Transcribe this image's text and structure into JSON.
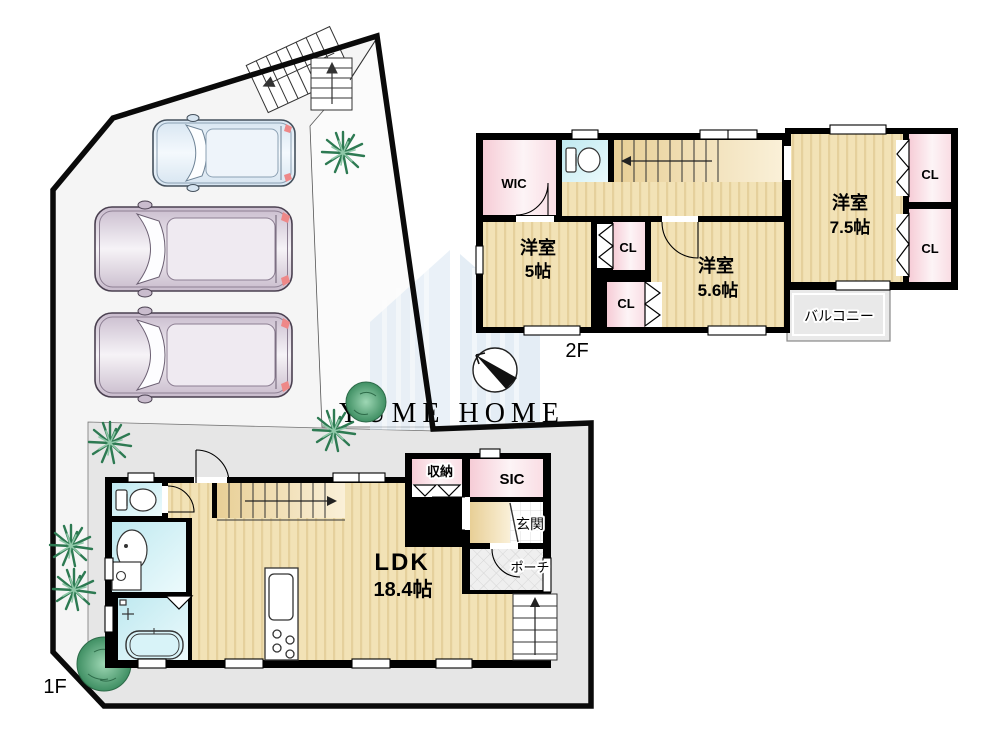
{
  "floor1": {
    "label": "1F",
    "ldk_name": "LDK",
    "ldk_size": "18.4帖",
    "storage": "収納",
    "sic": "SIC",
    "entrance": "玄関",
    "porch": "ポーチ"
  },
  "floor2": {
    "label": "2F",
    "wic": "WIC",
    "cl": "CL",
    "room5_name": "洋室",
    "room5_size": "5帖",
    "room56_name": "洋室",
    "room56_size": "5.6帖",
    "room75_name": "洋室",
    "room75_size": "7.5帖",
    "balcony": "バルコニー"
  },
  "watermark": {
    "text": "YUME HOME"
  },
  "colors": {
    "floor_tan": "#f2e2b6",
    "floor_stripe": "#e5d09c",
    "stair_tan": "#f5e8c6",
    "closet_pink": "#f6ccd6",
    "wet_cyan": "#bfe9f0",
    "balcony_gray": "#e9e9e9",
    "site_gray": "#f5f5f5",
    "yard_gray": "#e6e6e6",
    "wall_black": "#000000",
    "watermark_blue": "#c7d7e9",
    "car_mauve": "#c9bccd",
    "car_blue": "#d7e5f1",
    "tree_green": "#2d7a52"
  }
}
